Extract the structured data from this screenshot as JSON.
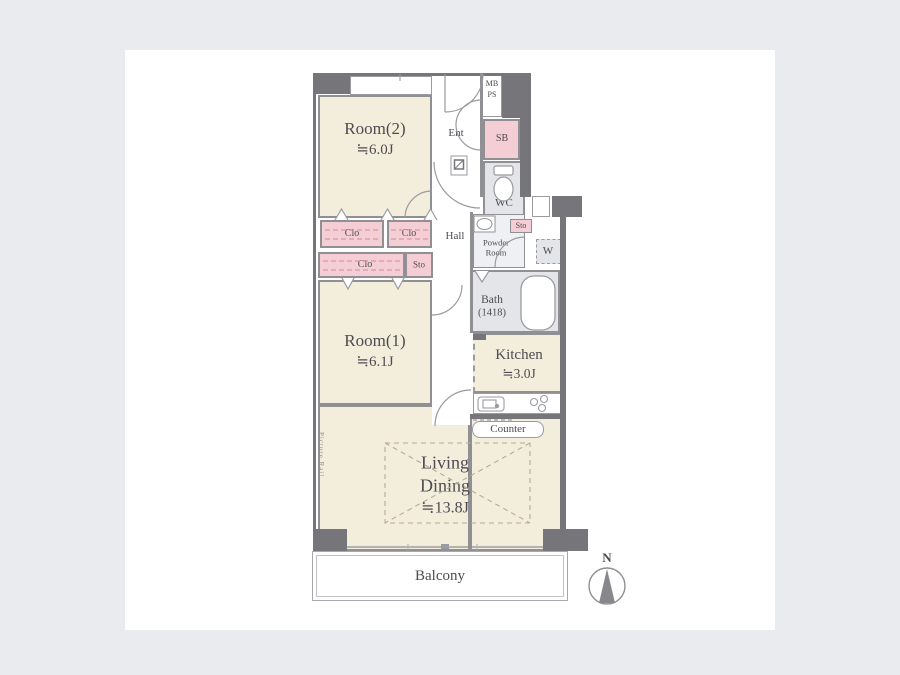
{
  "title": "Apartment floor plan",
  "colors": {
    "background": "#e9ebee",
    "card": "#ffffff",
    "room_cream": "#f3eedc",
    "closet_pink": "#f5cdd4",
    "wet_area_gray": "#e3e5e9",
    "wall_dark": "#75757a",
    "line_gray": "#8f8f94"
  },
  "rooms": {
    "room2": {
      "name": "Room(2)",
      "size": "≒6.0J"
    },
    "room1": {
      "name": "Room(1)",
      "size": "≒6.1J"
    },
    "living": {
      "line1": "Living",
      "line2": "Dining",
      "size": "≒13.8J"
    },
    "kitchen": {
      "name": "Kitchen",
      "size": "≒3.0J"
    },
    "bath": {
      "name": "Bath",
      "dim": "(1418)"
    },
    "powder": {
      "line1": "Powder",
      "line2": "Room"
    },
    "wc": "WC",
    "ent": "Ent",
    "hall": "Hall",
    "sb": "SB",
    "mb": "MB",
    "ps": "PS",
    "w": "W",
    "clo": "Clo",
    "sto": "Sto",
    "counter": "Counter",
    "balcony": "Balcony"
  },
  "annotations": {
    "picture_rail": "Picture Rail",
    "north": "N"
  }
}
